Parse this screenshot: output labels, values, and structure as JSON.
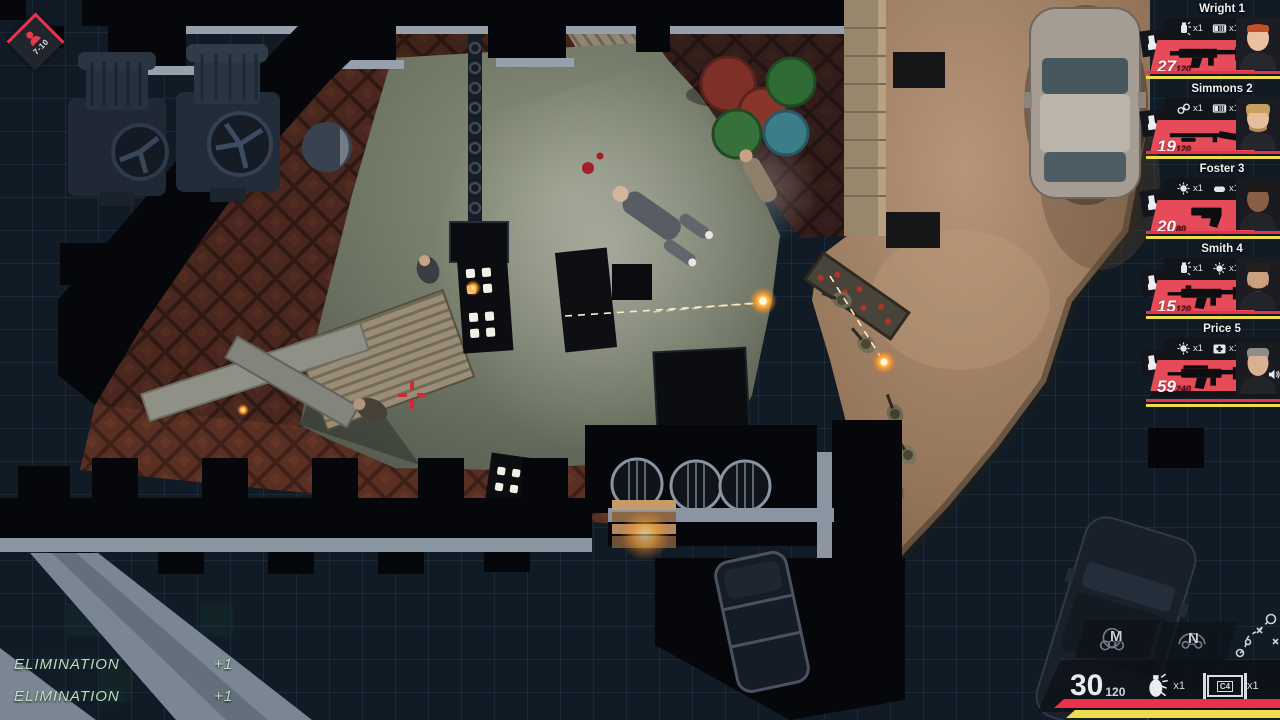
{
  "hud": {
    "enemy_counter": {
      "range": "7-10",
      "icon": "enemy-person-icon"
    },
    "squad": {
      "members": [
        {
          "name": "Wright 1",
          "ammo_mag": "27",
          "ammo_reserve": "120",
          "weapon": "smg",
          "gear": [
            "flashbang",
            "restraints-strip"
          ],
          "gear1_count": "x1",
          "gear2_count": "x1"
        },
        {
          "name": "Simmons 2",
          "ammo_mag": "19",
          "ammo_reserve": "120",
          "weapon": "shotgun",
          "gear": [
            "handcuffs",
            "restraints-strip"
          ],
          "gear1_count": "x1",
          "gear2_count": "x1"
        },
        {
          "name": "Foster 3",
          "ammo_mag": "20",
          "ammo_reserve": "80",
          "weapon": "pistol",
          "gear": [
            "stinger-grenade",
            "door-wedge"
          ],
          "gear1_count": "x1",
          "gear2_count": "x1"
        },
        {
          "name": "Smith 4",
          "ammo_mag": "15",
          "ammo_reserve": "120",
          "weapon": "rifle",
          "gear": [
            "flashbang",
            "stinger-grenade"
          ],
          "gear1_count": "x1",
          "gear2_count": "x1"
        },
        {
          "name": "Price 5",
          "ammo_mag": "59",
          "ammo_reserve": "240",
          "weapon": "rifle",
          "gear": [
            "stinger-grenade",
            "medkit"
          ],
          "gear1_count": "x1",
          "gear2_count": "x1"
        }
      ]
    },
    "eliminations": [
      {
        "label": "Elimination",
        "value": "+1"
      },
      {
        "label": "Elimination",
        "value": "+1"
      }
    ],
    "bottom_right": {
      "slot_m": "M",
      "slot_n": "N",
      "ammo_mag": "30",
      "ammo_reserve": "120",
      "flashbang_count": "x1",
      "c4_label": "C4",
      "c4_count": "x1"
    },
    "colors": {
      "accent_red": "#ef2f4e",
      "banner_red": "#e64b59",
      "bar_red": "#e8314a",
      "bar_yellow": "#ecdd4e",
      "elimination_green": "#cfeed8",
      "hud_text": "#e8edf2"
    }
  }
}
